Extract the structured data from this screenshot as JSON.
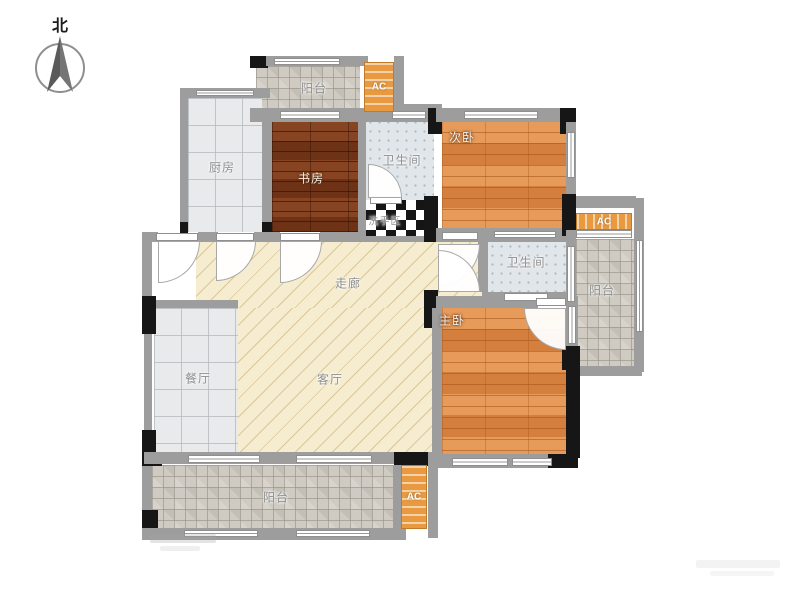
{
  "compass": {
    "label": "北"
  },
  "rooms": {
    "balcony_top": {
      "label": "阳台"
    },
    "kitchen": {
      "label": "厨房"
    },
    "study": {
      "label": "书房"
    },
    "bath_top": {
      "label": "卫生间"
    },
    "wash_area": {
      "label": "洗手区"
    },
    "bedroom_second": {
      "label": "次卧"
    },
    "bath_mid": {
      "label": "卫生间"
    },
    "balcony_right": {
      "label": "阳台"
    },
    "corridor": {
      "label": "走廊"
    },
    "dining": {
      "label": "餐厅"
    },
    "living": {
      "label": "客厅"
    },
    "bedroom_master": {
      "label": "主卧"
    },
    "balcony_bottom": {
      "label": "阳台"
    }
  },
  "ac_units": {
    "top": {
      "label": "AC"
    },
    "right": {
      "label": "AC"
    },
    "bottom": {
      "label": "AC"
    }
  },
  "colors": {
    "wall_gray": "#9d9d9d",
    "wall_black": "#161616",
    "wood_orange": "#e08a45",
    "wood_dark": "#7c3a1b",
    "floor_cream": "#f6edd0",
    "tile_light": "#e8eaeb",
    "tile_balcony": "#cfcbc2",
    "tile_bath": "#e1e6ea",
    "ac_orange": "#e9993f"
  }
}
